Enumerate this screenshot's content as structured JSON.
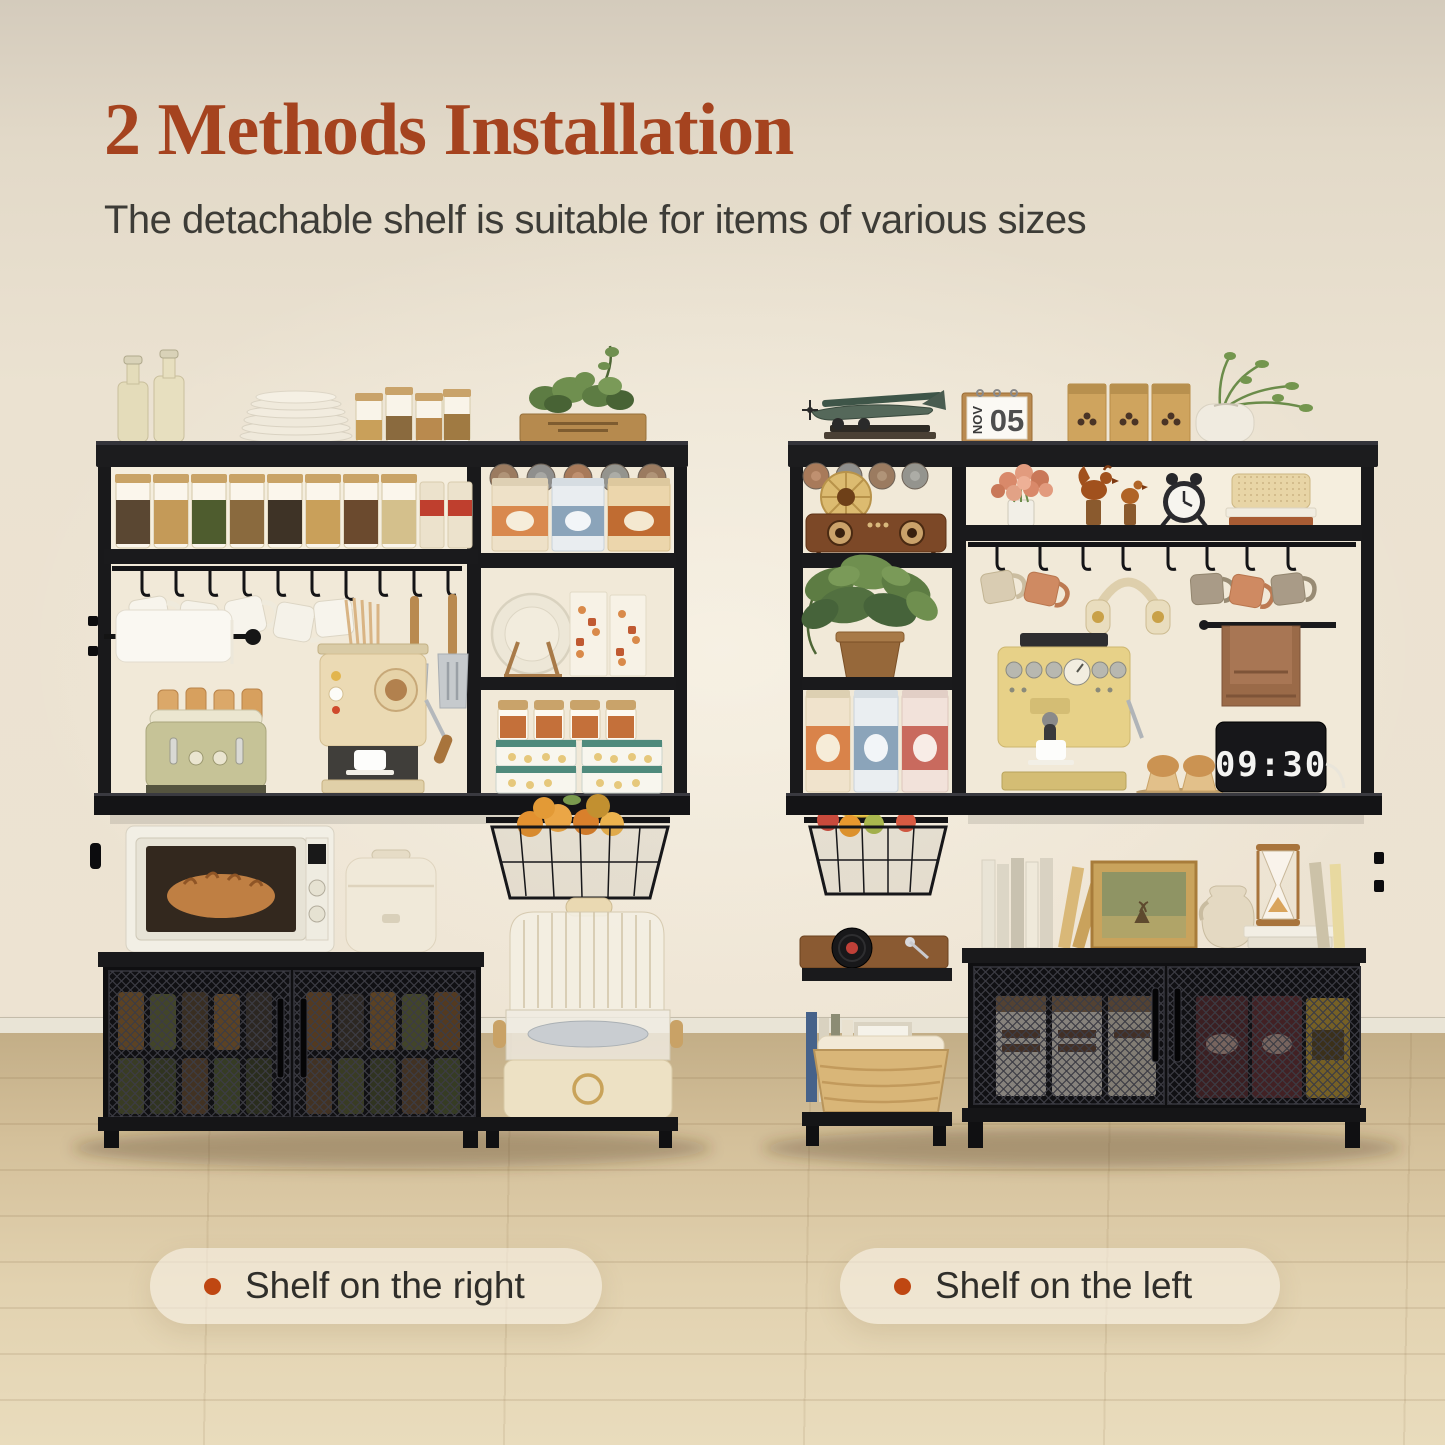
{
  "header": {
    "title": "2 Methods Installation",
    "subtitle": "The detachable shelf is suitable for items of various sizes",
    "title_color": "#a5431f",
    "subtitle_color": "#3d3c37"
  },
  "captions": {
    "left": {
      "text": "Shelf on the right"
    },
    "right": {
      "text": "Shelf on the left"
    },
    "bullet_color": "#bf4712",
    "pill_background": "rgba(247,240,229,0.62)"
  },
  "scene": {
    "wall_color": "#ede3d2",
    "baseboard_color": "#e9e4d6",
    "floor_color": "#d4c09a",
    "rack_frame_color": "#1b1b1d"
  },
  "left_rack": {
    "label": "bakers rack with storage shelf on the right",
    "top_items": [
      "glass bottles",
      "plate stack",
      "storage jars",
      "planter box with greenery"
    ],
    "hutch_items": [
      "spice jar shelf",
      "hanging white mugs",
      "chopsticks",
      "spatula",
      "slotted turner",
      "paper towel roll",
      "green toaster with bread",
      "cream espresso machine with cup"
    ],
    "lower_items": [
      "microwave with bread",
      "rice cooker",
      "mesh-door cabinet with preserved jars"
    ],
    "side_tower_items": [
      "stemware rack",
      "three canisters",
      "plate on wooden stand",
      "snack boxes",
      "cork jars",
      "teal-lid food containers",
      "pull-out fruit basket with oranges",
      "two-tier food steamer"
    ]
  },
  "right_rack": {
    "label": "bakers rack with storage shelf on the left",
    "calendar": {
      "month": "NOV",
      "day": "05"
    },
    "clock_time": "09:30",
    "top_items": [
      "vintage model airplane on books",
      "flip calendar",
      "coffee bean bags",
      "vase with green branches"
    ],
    "hutch_items": [
      "rose bouquet in glass",
      "wooden rooster figurines",
      "alarm clock",
      "rattan box on books",
      "hanging mugs",
      "headphones",
      "towel on side bar",
      "yellow espresso machine",
      "cupcakes",
      "tablet flip clock"
    ],
    "lower_items": [
      "books",
      "gold framed picture",
      "jug vase",
      "hourglass on books",
      "mesh-door cabinet with food packs"
    ],
    "side_tower_items": [
      "stemware rack",
      "wooden radio with horn speaker",
      "potted trailing plant",
      "three canisters",
      "pull-out fruit basket with bananas and apples",
      "record player",
      "books, framed sprig and wicker basket"
    ]
  }
}
